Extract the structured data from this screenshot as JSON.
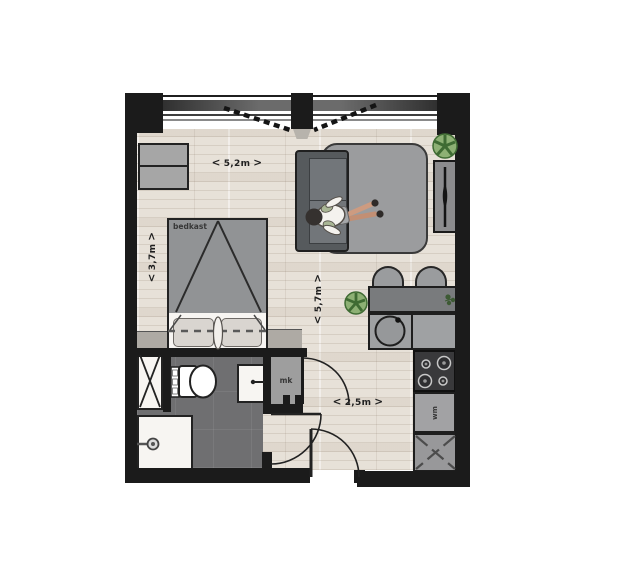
{
  "plan": {
    "title": "Studio apartment floor plan",
    "chevrons": {
      "left": "<",
      "right": ">"
    },
    "dimensions": {
      "top_width": "5,2m",
      "bed_depth": "3,7m",
      "room_length": "5,7m",
      "hall_width": "2,5m"
    },
    "labels": {
      "bed_cabinet": "bedkast",
      "meter_closet": "mk",
      "washing_machine": "wm"
    },
    "colors": {
      "wall": "#1b1b1b",
      "floor_light": "#e7e1d8",
      "floor_shadow": "#d3ccc2",
      "bathroom_floor": "#6f6f71",
      "furniture_gray": "#919395",
      "sofa_dark": "#565a5d",
      "rug_gray": "#9b9c9e",
      "plant_green": "#8db074",
      "stove_dark": "#39393b",
      "white": "#ffffff"
    }
  }
}
